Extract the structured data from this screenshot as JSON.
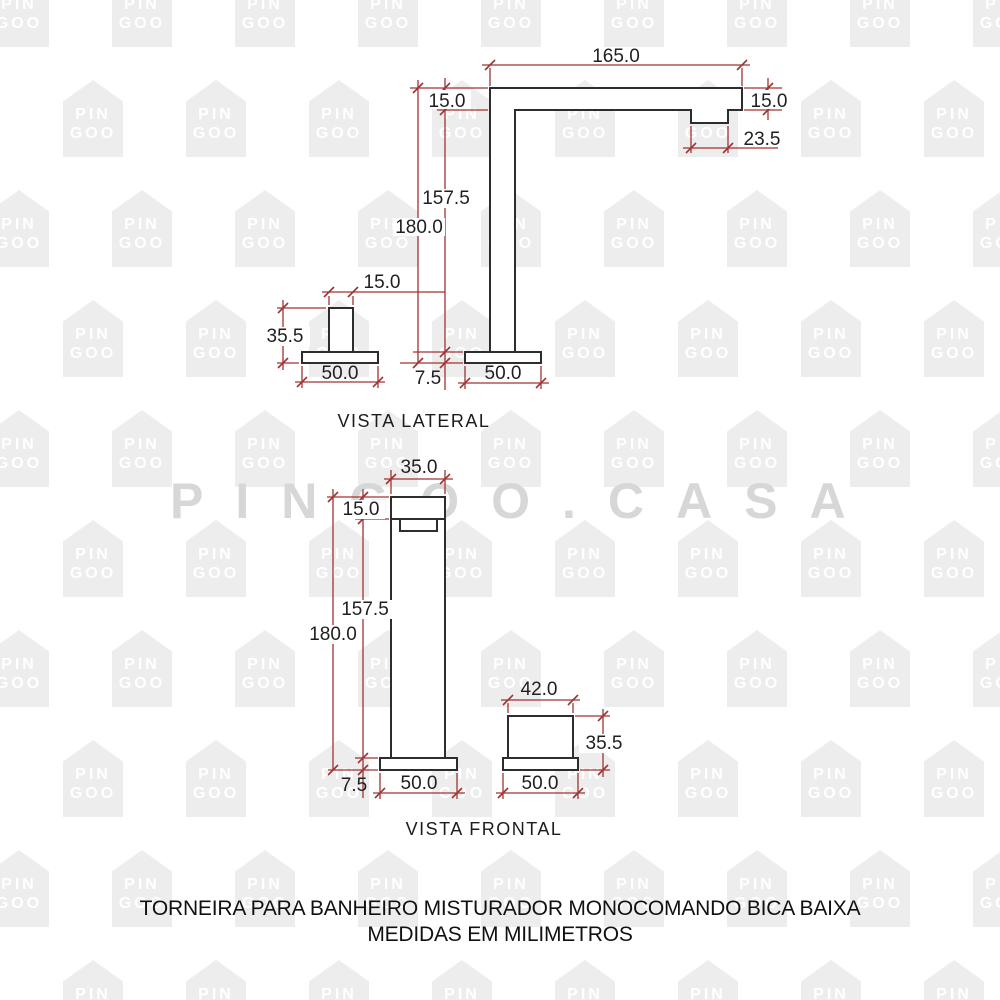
{
  "watermark": {
    "tile_line1": "PIN",
    "tile_line2": "GOO",
    "brand": "PINGOO.CASA"
  },
  "lateral": {
    "caption": "VISTA LATERAL",
    "dims": {
      "spout_length": "165.0",
      "arm_thickness": "15.0",
      "spout_end": "15.0",
      "spout_tip": "23.5",
      "under_spout_height": "157.5",
      "total_height": "180.0",
      "handle_width": "15.0",
      "handle_height": "35.5",
      "handle_base_width": "50.0",
      "base_thickness": "7.5",
      "base_width": "50.0"
    }
  },
  "frontal": {
    "caption": "VISTA FRONTAL",
    "dims": {
      "body_width": "35.0",
      "cap_height": "15.0",
      "under_spout_height": "157.5",
      "total_height": "180.0",
      "knob_width": "42.0",
      "knob_height": "35.5",
      "base_thickness": "7.5",
      "base_width": "50.0",
      "knob_base_width": "50.0"
    }
  },
  "footer": {
    "line1": "TORNEIRA PARA BANHEIRO MISTURADOR MONOCOMANDO BICA BAIXA",
    "line2": "MEDIDAS EM MILIMETROS"
  },
  "colors": {
    "dimension_lines": "#a03333",
    "dimension_text": "#1f1f1f",
    "drawing_outline": "#2d2d2d",
    "watermark_tile": "#ededed",
    "watermark_tile_text": "#ffffff",
    "brand_watermark": "#d7d7d7"
  }
}
